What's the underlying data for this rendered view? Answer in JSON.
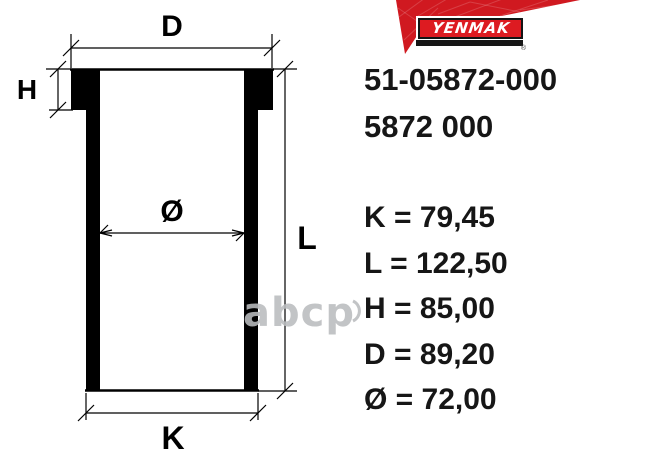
{
  "brand": {
    "name": "YENMAK",
    "logo_text": "YENMAK",
    "registered_mark": "®",
    "banner_color": "#d01920",
    "logo_red": "#dd1b21"
  },
  "part_numbers": {
    "primary": "51-05872-000",
    "secondary": "5872 000"
  },
  "specs": {
    "rows": [
      {
        "key": "K",
        "value": "79,45",
        "text": "K = 79,45"
      },
      {
        "key": "L",
        "value": "122,50",
        "text": "L = 122,50"
      },
      {
        "key": "H",
        "value": "85,00",
        "text": "H = 85,00"
      },
      {
        "key": "D",
        "value": "89,20",
        "text": "D = 89,20"
      },
      {
        "key": "Ø",
        "value": "72,00",
        "text": "Ø = 72,00"
      }
    ]
  },
  "diagram_labels": {
    "d": "D",
    "h": "H",
    "bore": "Ø",
    "l": "L",
    "k": "K"
  },
  "watermark": {
    "text": "abcp"
  },
  "colors": {
    "text_black": "#161616",
    "line_black": "#000000",
    "watermark_grey": "#b9bcbe"
  }
}
